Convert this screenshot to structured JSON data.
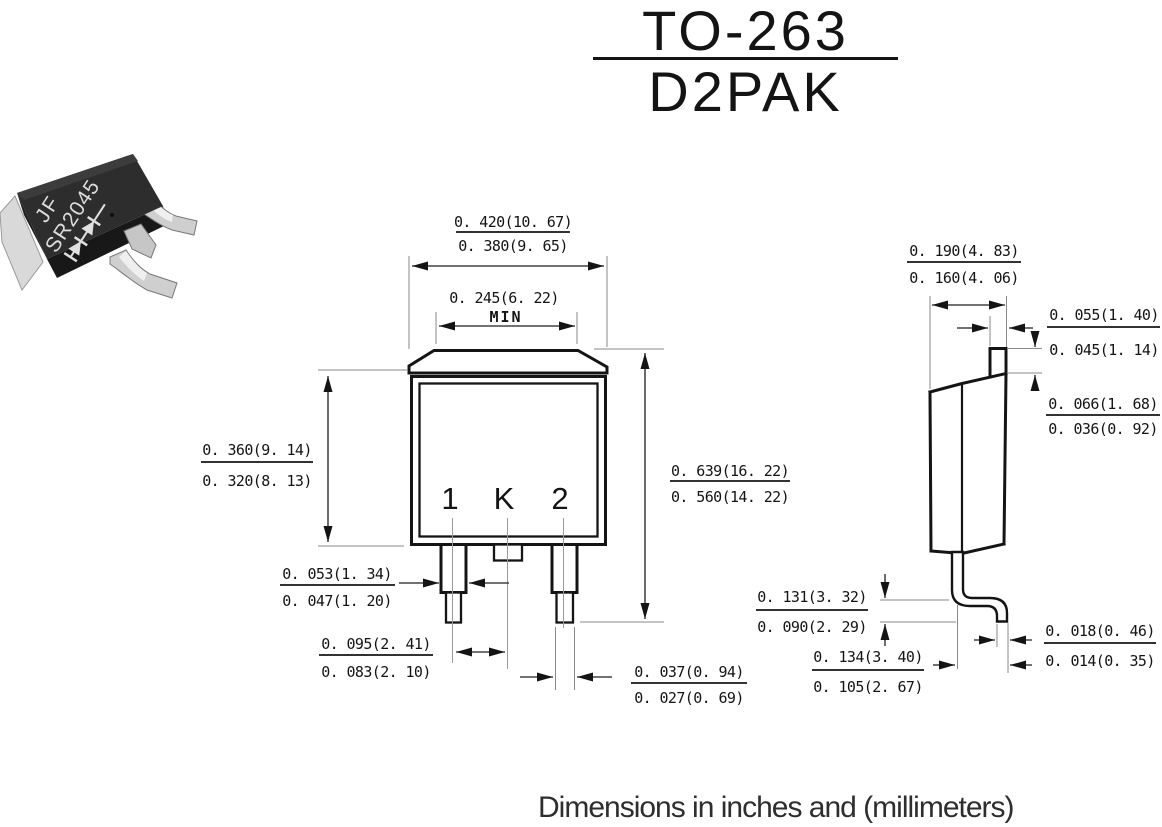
{
  "title": {
    "line1": "TO-263",
    "line2": "D2PAK"
  },
  "photo": {
    "marking_line1": "JF",
    "marking_line2": "SR2045"
  },
  "front_view": {
    "pin_labels": {
      "left": "1",
      "center": "K",
      "right": "2"
    },
    "dims": {
      "overall_width": {
        "max": "0. 420(10. 67)",
        "min": "0. 380(9. 65)"
      },
      "tab_width": {
        "value": "0. 245(6. 22)",
        "qualifier": "MIN"
      },
      "body_height": {
        "max": "0. 360(9. 14)",
        "min": "0. 320(8. 13)"
      },
      "overall_height": {
        "max": "0. 639(16. 22)",
        "min": "0. 560(14. 22)"
      },
      "lead_width": {
        "max": "0. 053(1. 34)",
        "min": "0. 047(1. 20)"
      },
      "lead_pitch": {
        "max": "0. 095(2. 41)",
        "min": "0. 083(2. 10)"
      },
      "lead_tip_width": {
        "max": "0. 037(0. 94)",
        "min": "0. 027(0. 69)"
      }
    }
  },
  "side_view": {
    "dims": {
      "body_thickness": {
        "max": "0. 190(4. 83)",
        "min": "0. 160(4. 06)"
      },
      "tab_thickness": {
        "max": "0. 055(1. 40)",
        "min": "0. 045(1. 14)"
      },
      "tab_step_height": {
        "max": "0. 066(1. 68)",
        "min": "0. 036(0. 92)"
      },
      "lead_standoff": {
        "max": "0. 131(3. 32)",
        "min": "0. 090(2. 29)"
      },
      "foot_length": {
        "max": "0. 134(3. 40)",
        "min": "0. 105(2. 67)"
      },
      "lead_thickness": {
        "max": "0. 018(0. 46)",
        "min": "0. 014(0. 35)"
      }
    }
  },
  "footer": {
    "note": "Dimensions in inches and (millimeters)"
  },
  "colors": {
    "line": "#141414",
    "package_body": "#2d2d2d",
    "lead_metal": "#cfcfcf"
  }
}
